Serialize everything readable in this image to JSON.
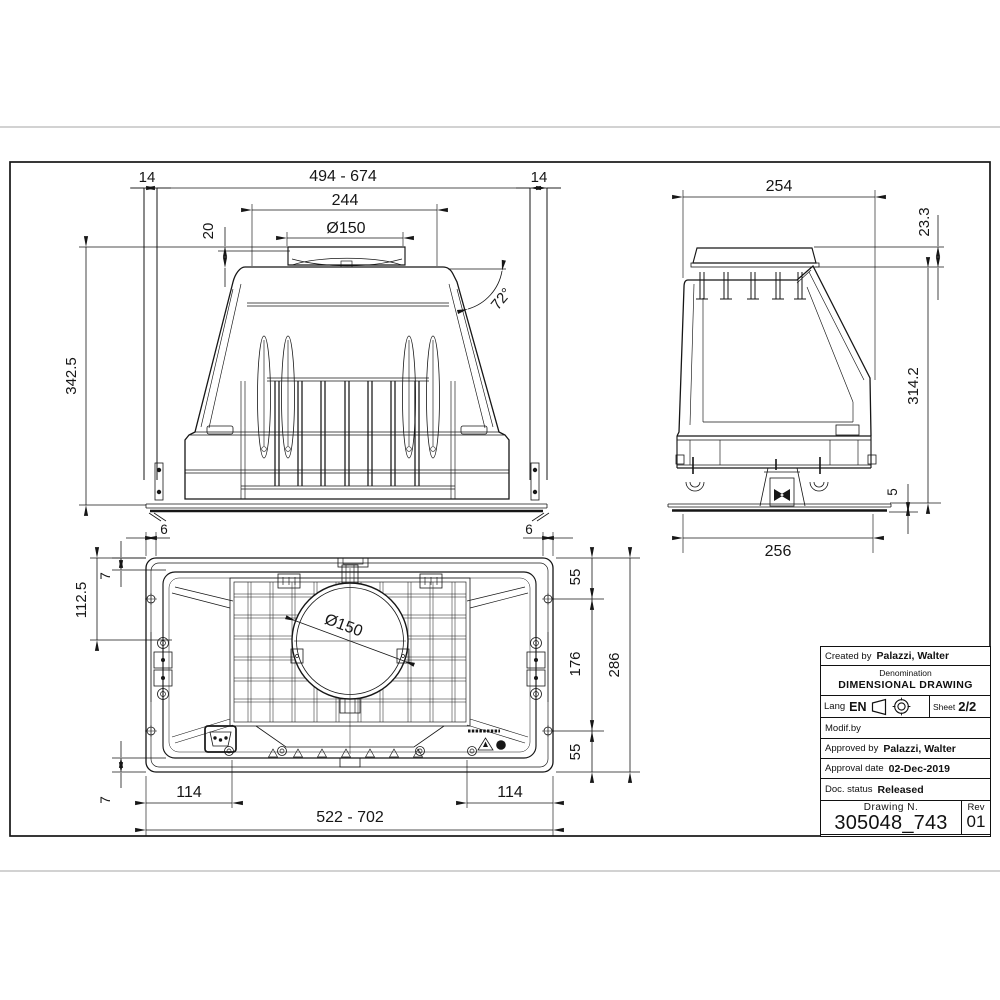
{
  "page": {
    "bg": "#ffffff",
    "ink": "#161616",
    "page_edge_line": "#c4c4c4"
  },
  "views": {
    "front": {
      "dims": {
        "clearance_left": "14",
        "opening_width_range": "494 - 674",
        "clearance_right": "14",
        "top_plate_width": "244",
        "duct_diameter": "Ø150",
        "collar_height": "20",
        "overall_height": "342.5",
        "side_angle": "72°"
      }
    },
    "side": {
      "dims": {
        "top_depth": "254",
        "collar_height": "23.3",
        "body_height": "314.2",
        "flange_thickness": "5",
        "base_depth": "256"
      }
    },
    "plan": {
      "dims": {
        "edge_offset_left": "6",
        "edge_offset_right": "6",
        "rim_offset_top": "7",
        "duct_center_offset": "112.5",
        "duct_diameter": "Ø150",
        "side_segment_top": "55",
        "bracket_span": "176",
        "overall_depth": "286",
        "side_segment_bottom": "55",
        "rim_offset_bottom": "7",
        "corner_offset_left": "114",
        "body_width_range": "522 - 702",
        "corner_offset_right": "114"
      }
    }
  },
  "title_block": {
    "created_by_label": "Created by",
    "created_by_value": "Palazzi, Walter",
    "denomination_label": "Denomination",
    "denomination_value": "DIMENSIONAL DRAWING",
    "lang_label": "Lang",
    "lang_value": "EN",
    "sheet_label": "Sheet",
    "sheet_value": "2/2",
    "modif_by_label": "Modif.by",
    "approved_by_label": "Approved by",
    "approved_by_value": "Palazzi, Walter",
    "approval_date_label": "Approval date",
    "approval_date_value": "02-Dec-2019",
    "doc_status_label": "Doc. status",
    "doc_status_value": "Released",
    "drawing_n_label": "Drawing N.",
    "drawing_n_value": "305048_743",
    "rev_label": "Rev",
    "rev_value": "01"
  }
}
